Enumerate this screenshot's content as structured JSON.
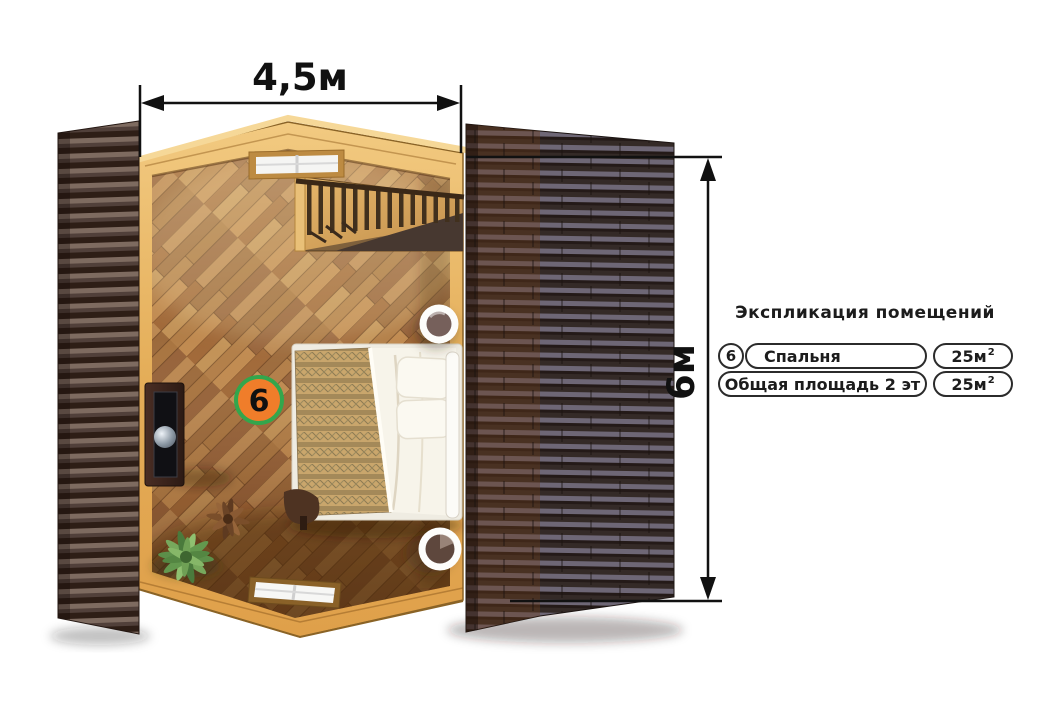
{
  "dimensions": {
    "width_label": "4,5м",
    "height_label": "6м"
  },
  "plan": {
    "room_badge": "6"
  },
  "legend": {
    "title": "Экспликация помещений",
    "rows": [
      {
        "number": "6",
        "name": "Спальня",
        "area": "25м",
        "area_sup": "2"
      },
      {
        "name": "Общая площадь 2 эт",
        "area": "25м",
        "area_sup": "2"
      }
    ]
  },
  "colors": {
    "badge_fill": "#f07d2a",
    "badge_ring": "#33a64c",
    "dimension_line": "#111111",
    "pine_wood": "#e7b264",
    "roof_left": "#7e6b60",
    "roof_right": "#6e6776"
  }
}
